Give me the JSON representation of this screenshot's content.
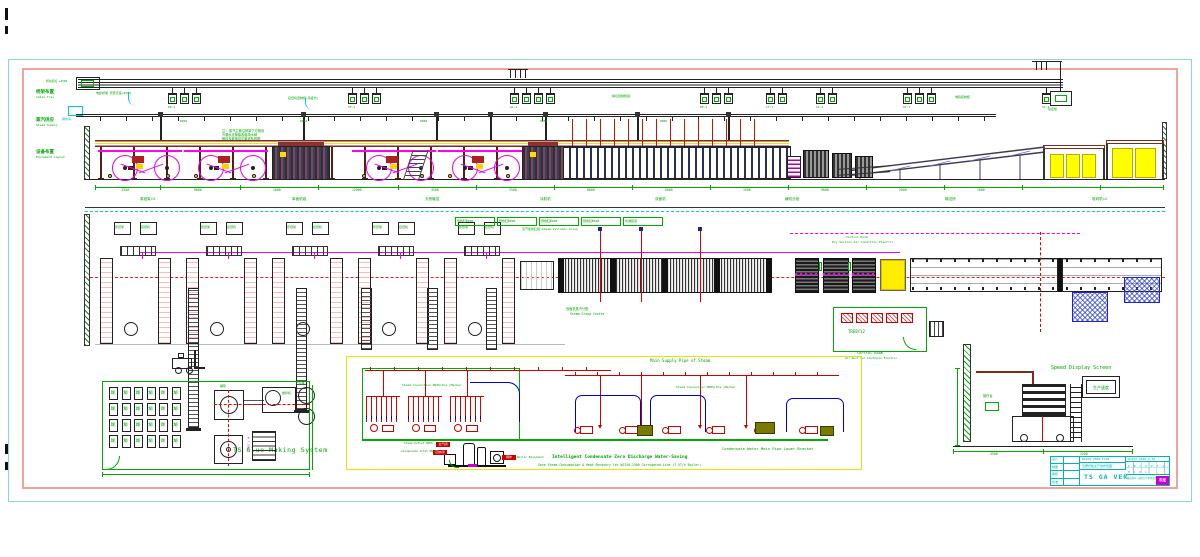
{
  "sheet": {
    "side_labels": [
      {
        "cn": "桥架布置",
        "en": "Cable Tray"
      },
      {
        "cn": "蒸汽供应",
        "en": "Steam Supply"
      },
      {
        "cn": "设备布置",
        "en": "Equipment Layout"
      }
    ],
    "boiler_room_label": "锅炉房",
    "tray": {
      "start_label": "桥架起点 +4500",
      "riser_cabinet_label": "总控柜",
      "notes": [
        "电缆桥架 安装高度+4500",
        "接纸机控制柜(吊挂式)",
        "横切控制柜组",
        "堆码控制柜"
      ],
      "clusters": [
        {
          "label": "RS-1"
        },
        {
          "label": "SF-1"
        },
        {
          "label": "GL-1"
        },
        {
          "label": "DF-1"
        },
        {
          "label": "CT-1"
        },
        {
          "label": "SL-1"
        },
        {
          "label": "ST-1"
        },
        {
          "label": "ST-2"
        }
      ]
    },
    "steam": {
      "sizes": [
        "DN25",
        "DN32",
        "DN40",
        "DN50",
        "DN65"
      ],
      "note_lines": [
        "注: 蒸汽主管沿桥架下方敷设",
        "冷凝水支管接各组疏水阀",
        "管径及坡度详见管道系统图"
      ]
    },
    "elevation": {
      "dims": [
        "2550",
        "8000",
        "1600",
        "12000",
        "4500",
        "2500",
        "8000",
        "6000",
        "1500",
        "9000",
        "2000",
        "1000"
      ],
      "sections": [
        "原纸架×5",
        "单面机组",
        "天桥输送",
        "涂胶机",
        "双面机",
        "横切分纸",
        "输送桥",
        "堆码机×2"
      ]
    },
    "plan": {
      "stand_box_left": "原纸架",
      "stand_box_right": "接纸机",
      "heater_boxes": [
        "预热缸Φ900",
        "预热缸Φ900",
        "预热缸Φ900",
        "预热缸Φ600",
        "喷淋装置"
      ],
      "heater_caption": "蒸汽加热缸组 Steam Cylinder Group",
      "df_label_1": "双面机蒸汽分配",
      "df_label_2": "Steam Group Center",
      "cr_top_1": "Control Room",
      "cr_top_2": "Dry Section Air Condition Electric"
    },
    "control_room": {
      "inside": "TRE8Y12",
      "label": "Control Room",
      "sub": "Air Duct for Condition Electric"
    },
    "glue": {
      "title": "TS Glue Making System",
      "tank_char": "糊",
      "pump": "糊泵",
      "mixer": "搅拌机",
      "store": "贮存桶",
      "motor": "M 7.5kW"
    },
    "piping": {
      "title": "Main Supply Pipe of Steam",
      "branch1": "Steam Connection DN25(Dia.)Marker",
      "branch2": "Steam Connection DN65(Dia.)Marker",
      "condensate": "Condensate Water Main Pipe Lower Bracket",
      "highlight": "Intelligent Condensate Zero Discharge Water-Saving",
      "note": "Save Steam Consumption & Heat Recovery for WJ250-2500 Corrugated Line (7.5T/h Boiler)",
      "steam_out": "Steam Outlet DN50",
      "cond_in": "Condensate Inlet DN40",
      "equip": "Boiler Equipment",
      "chip1": "主汽阀",
      "chip2": "回水阀",
      "chip3": "锅炉"
    },
    "speed": {
      "title": "Speed Display Screen",
      "display": "生产速度",
      "console": "操作台",
      "dim1": "4500",
      "dim2": "3200"
    },
    "title_block": {
      "big": "TS GA VER",
      "row1": "WJ250-2500-TSJR",
      "row2": "瓦楞纸板生产线布置图",
      "doc_no": "WJ250-2500-2-10",
      "revs": "A B C D E F G H J K L",
      "bottom": "版权所有·未经许可不得复制",
      "logo": "东经",
      "left_rows": [
        "设计",
        "制图",
        "审核",
        "批准"
      ]
    }
  }
}
